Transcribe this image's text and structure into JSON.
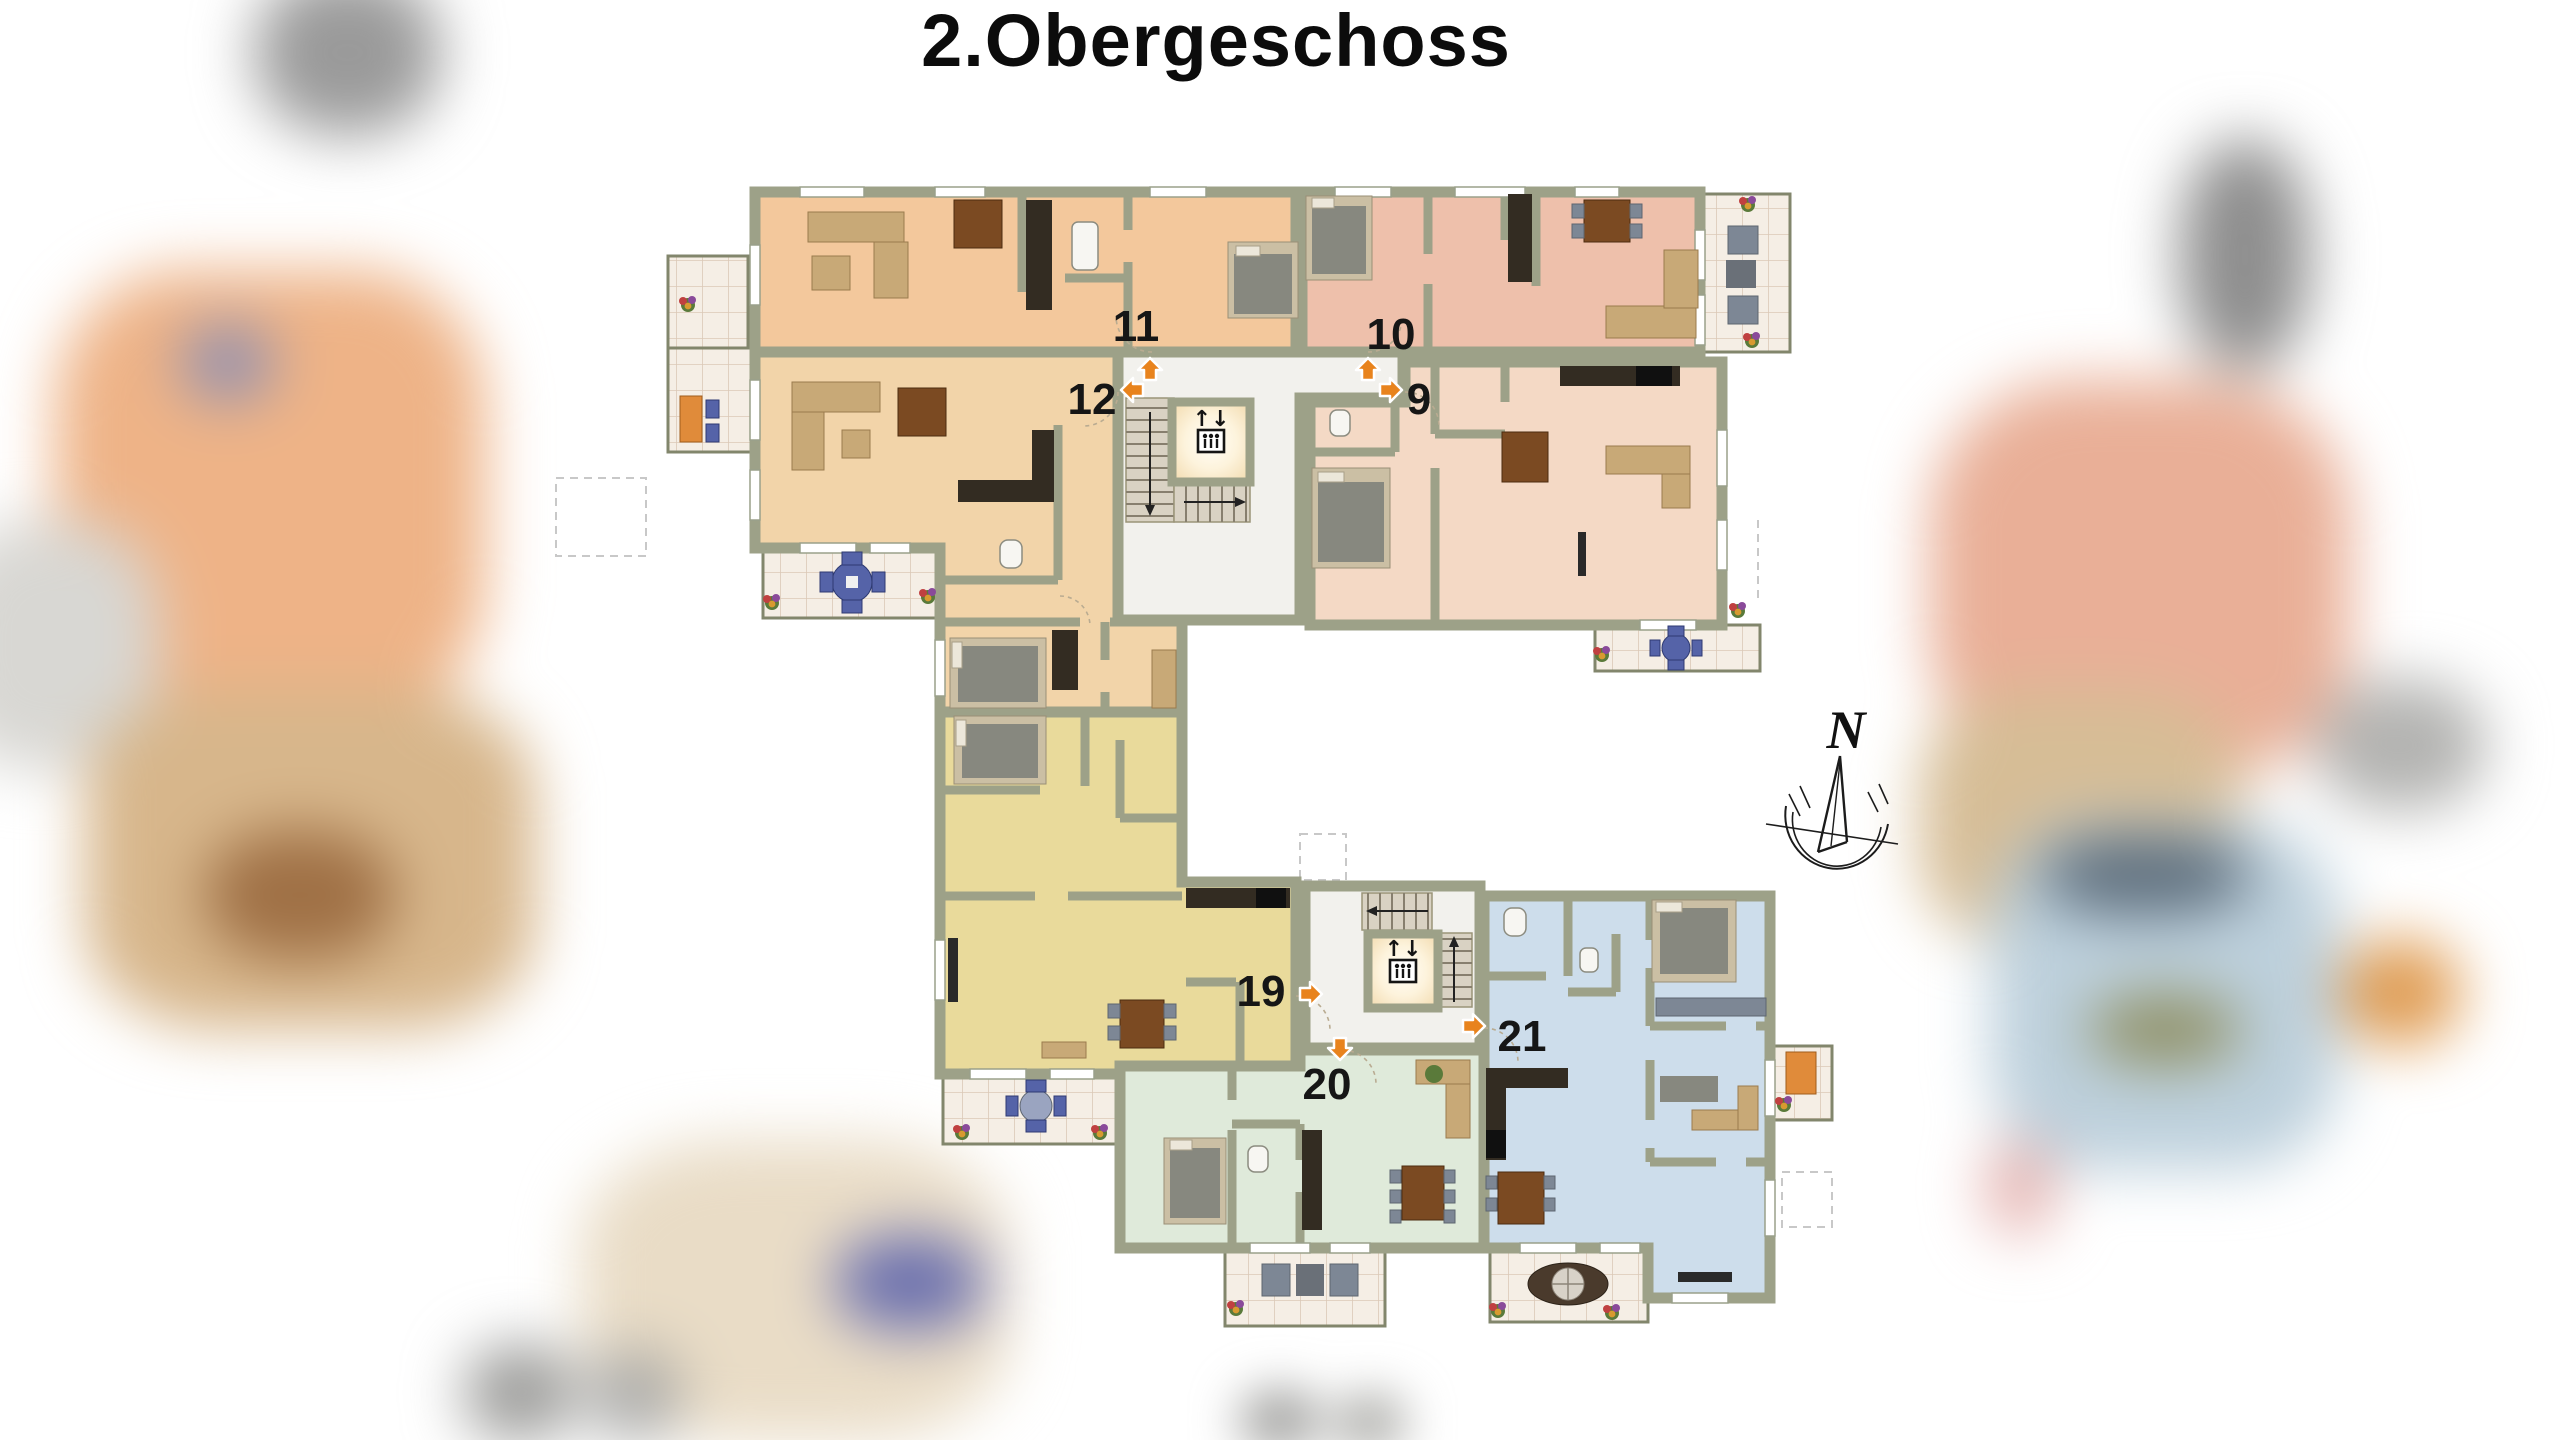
{
  "title": "2.Obergeschoss",
  "compass": {
    "label": "N"
  },
  "elevator": {
    "symbol": "↑↓"
  },
  "apartments": [
    {
      "number": "9",
      "color": "#f4d9c5"
    },
    {
      "number": "10",
      "color": "#eec0ab"
    },
    {
      "number": "11",
      "color": "#f3c89c"
    },
    {
      "number": "12",
      "color": "#f2d4a9"
    },
    {
      "number": "19",
      "color": "#e9da9b"
    },
    {
      "number": "20",
      "color": "#dfeada"
    },
    {
      "number": "21",
      "color": "#cdddeb"
    }
  ],
  "colors": {
    "wall": "#9da188",
    "wallDark": "#82866c",
    "hall": "#f2f1ed",
    "terrace": "#f5eee5",
    "terraceLine": "#dbc8b7",
    "arrow": "#e8831d",
    "labelText": "#161616",
    "kitchenDark": "#332c22",
    "woodBrown": "#7b4a22",
    "bedGray": "#87887f",
    "furnTan": "#c8a977",
    "chairGray": "#7d8795",
    "blueSet": "#5563a8"
  }
}
